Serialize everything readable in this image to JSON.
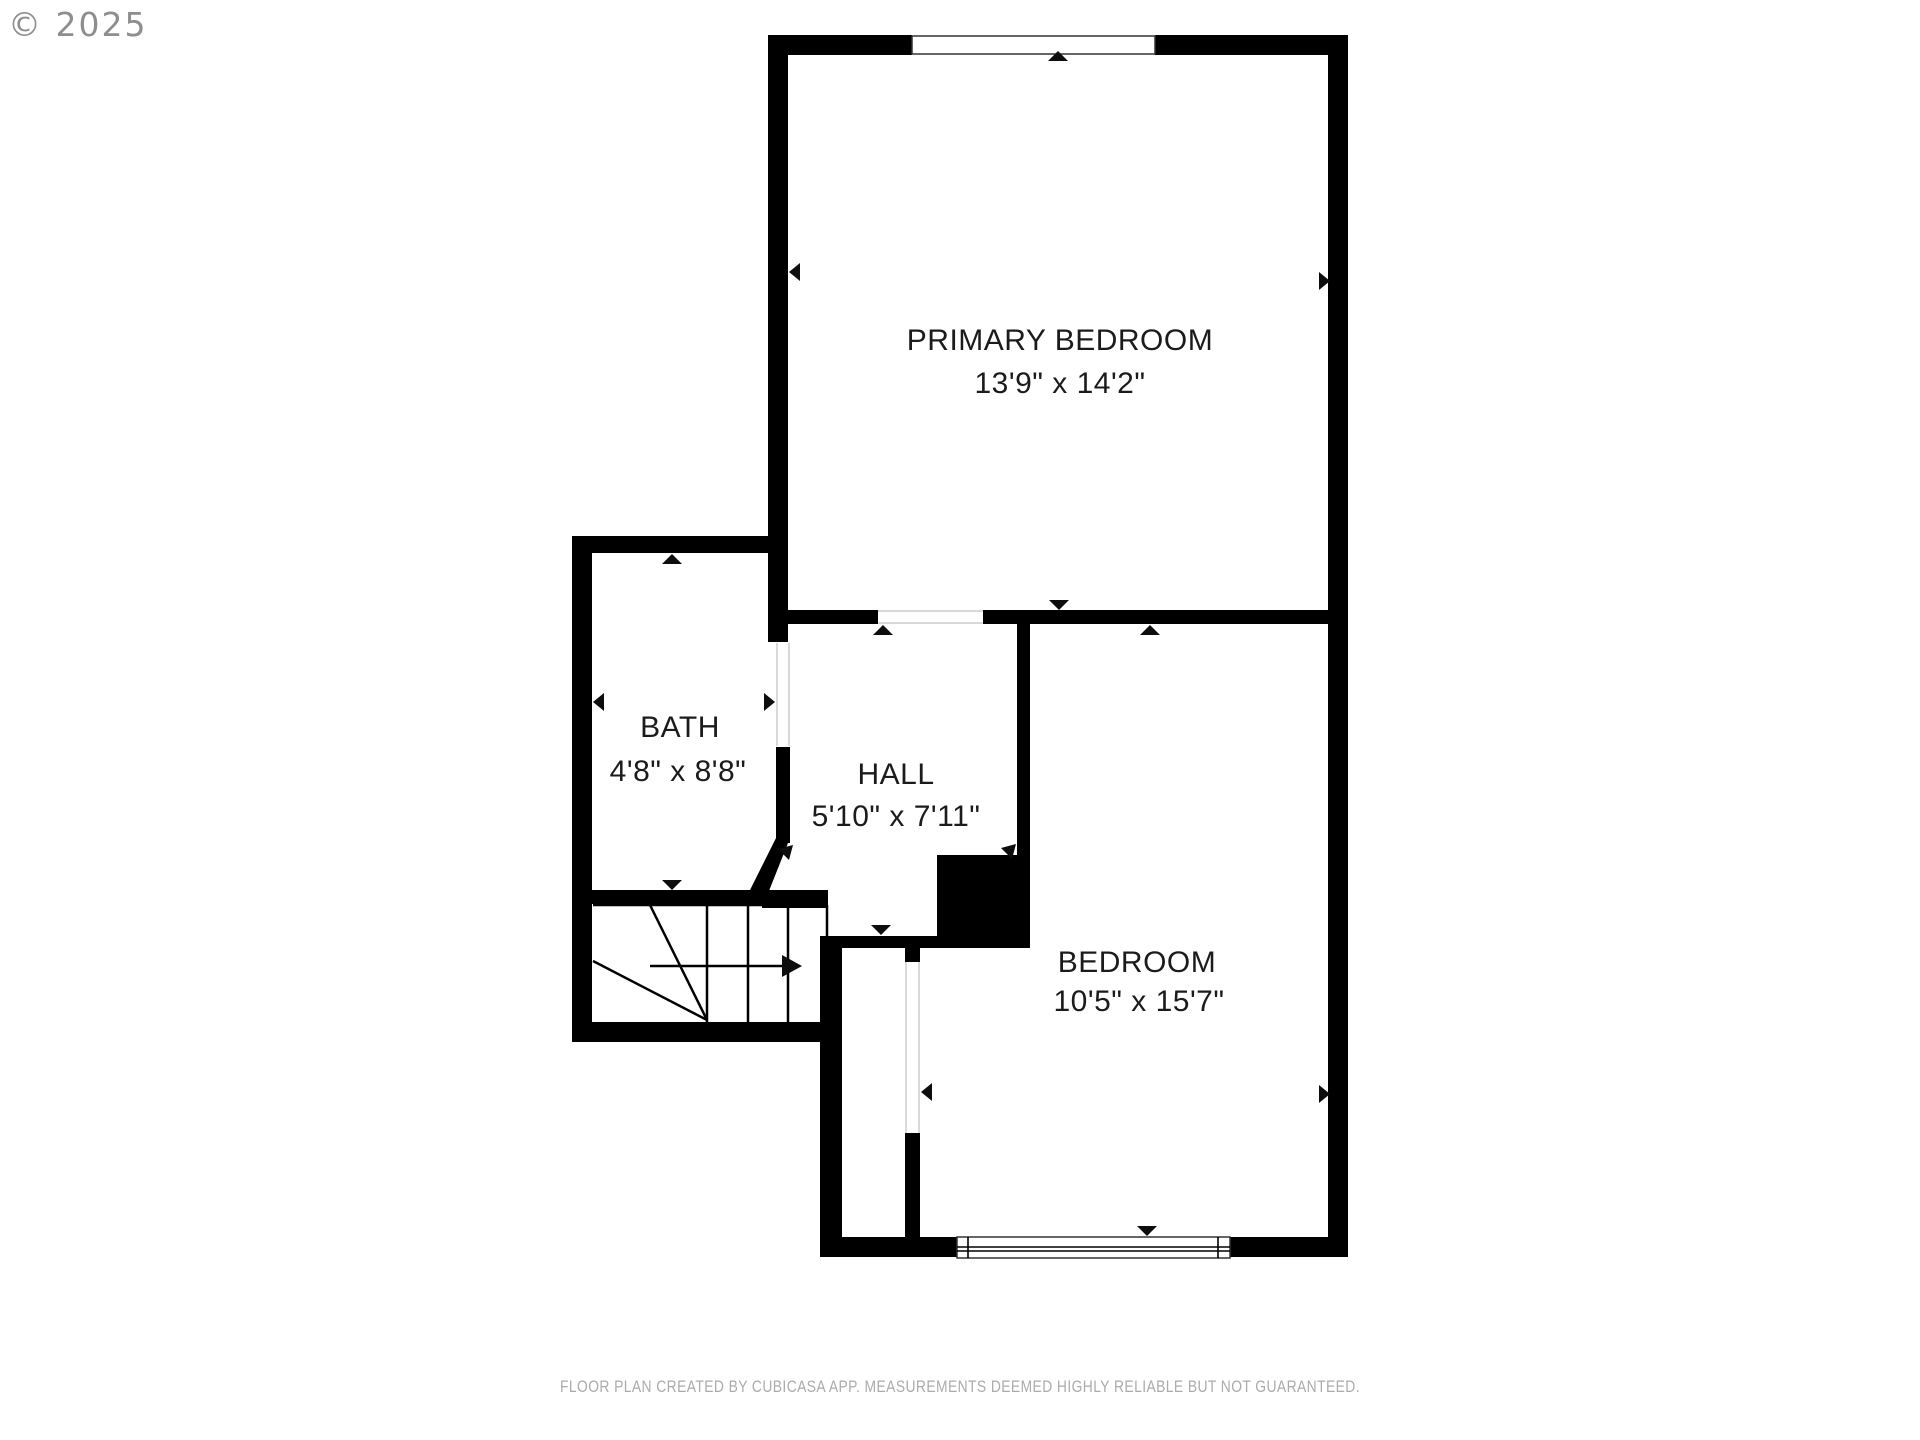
{
  "watermark": "© 2025",
  "rooms": [
    {
      "id": "primary-bedroom",
      "name": "PRIMARY BEDROOM",
      "dimensions": "13'9\" x 14'2\""
    },
    {
      "id": "bath",
      "name": "BATH",
      "dimensions": "4'8\" x 8'8\""
    },
    {
      "id": "hall",
      "name": "HALL",
      "dimensions": "5'10\" x 7'11\""
    },
    {
      "id": "bedroom",
      "name": "BEDROOM",
      "dimensions": "10'5\" x 15'7\""
    }
  ],
  "footer": "FLOOR PLAN CREATED BY CUBICASA APP. MEASUREMENTS DEEMED HIGHLY RELIABLE BUT NOT GUARANTEED.",
  "colors": {
    "wall": "#000000",
    "label": "#1b1b1b",
    "watermark": "#8e8e8e",
    "footer": "#ababab"
  }
}
